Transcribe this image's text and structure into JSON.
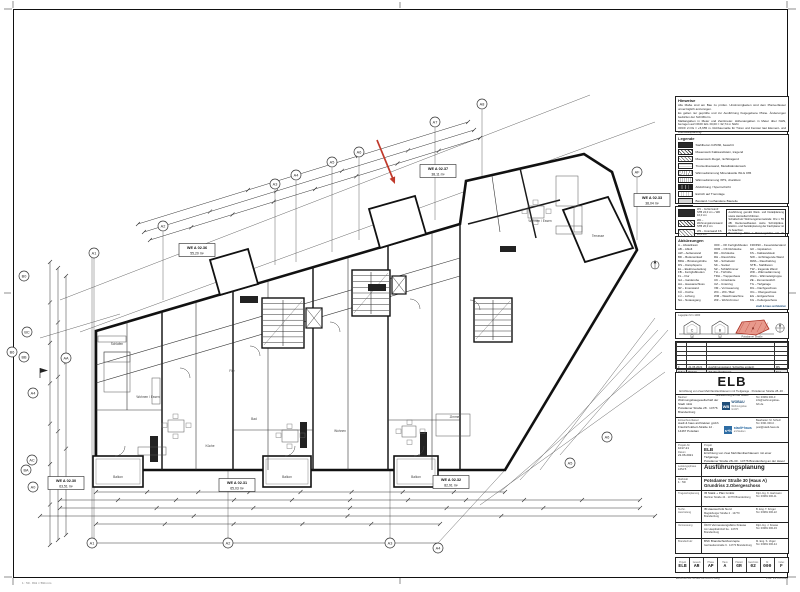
{
  "notes": {
    "title": "Hinweise",
    "lines": [
      "Alle Maße sind am Bau zu prüfen. Unstimmigkeiten sind dem Planverfasser unverzüglich anzuzeigen.",
      "Es gelten nur geprüfte und zur Ausführung freigegebene Pläne. Änderungen bedürfen der Schriftform.",
      "Maßangaben in Meter und Zentimeter. Höhenangaben in Meter über NHN, bezogen auf OKFF EG ±0,00 = 32,74 m NHN.",
      "OKFF 2.OG = +5,655 m. Rohbaumaße für Türen und Fenster laut Element- und Werkstattplanung.",
      "Brandschutz gemäß Brandschutzkonzept, Schallschutz nach DIN 4109, Wärmeschutz nach GEG.",
      "Türen: lichte Durchgangsmaße. Brüstungshöhen ab OKFF, BRH siehe Fensterliste.",
      "Abkürzungen und Legende siehe nebenstehende Übersicht."
    ]
  },
  "legend": {
    "title": "Legende",
    "items": [
      {
        "swatch": "solid",
        "label": "Stahlbeton C25/30, bewehrt"
      },
      {
        "swatch": "diag",
        "label": "Mauerwerk Kalksandstein, tragend"
      },
      {
        "swatch": "cross",
        "label": "Mauerwerk Ziegel, nichttragend"
      },
      {
        "swatch": "light",
        "label": "Trockenbauwand, Metallständerwerk"
      },
      {
        "swatch": "dots",
        "label": "Wärmedämmung Mineralwolle WLG 035"
      },
      {
        "swatch": "wave",
        "label": "Wärmedämmung XPS, druckfest"
      },
      {
        "swatch": "dark2",
        "label": "Abdichtung / Sperrschicht"
      },
      {
        "swatch": "grid",
        "label": "Estrich auf Trennlage"
      },
      {
        "swatch": "gray",
        "label": "Bestand / vorhandene Bauteile"
      },
      {
        "swatch": "hatch2",
        "label": "Installationsebene / Vorsatzschale"
      },
      {
        "swatch": "reddash",
        "label": "Umgrenzung Sicherheitstreppenraum"
      }
    ],
    "wall_types": [
      "W1 – Außenwand STB 24,0 cm + WD 16,0 cm",
      "W2 – Wohnungstrennwand STB 20,0 cm",
      "W3 – Innenwand KS 11,5 cm",
      "W4 – Trockenbauwand 10,0 cm"
    ],
    "note_box": [
      "Ausführung gemäß Werk- und Detailplanung sowie Herstellerrichtlinien.",
      "Schallschutz Wohnungstrennwände: R'w ≥ 55 dB. Deckenaufbauten siehe Schnittpläne. Elektro- und Sanitärplanung der Fachplaner ist zu beachten.",
      "Bemaßung: BRH = Brüstungshöhe roh ab OKRF. Alle Durchbrüche mit den Fachgewerken vor Ausführung abzustimmen."
    ]
  },
  "abbreviations": {
    "title": "Abkürzungen",
    "columns": [
      [
        "A – Abstellraum",
        "AB – Abluft",
        "AW – Außenwand",
        "BD – Bodeneinlauf",
        "BRH – Brüstungshöhe",
        "DS – Dampfsperre",
        "EL – Elektroverteilung",
        "FB – Fertigfußboden",
        "FL – Flur",
        "GA – Garderobe",
        "HA – Hausanschluss",
        "IW – Innenwand",
        "KÜ – Küche",
        "LÜ – Lüftung",
        "NA – Notausgang"
      ],
      [
        "OKF – OK Fertigfußboden",
        "OKR – OK Rohdecke",
        "RD – Rohdecke",
        "RH – Raumhöhe",
        "SD – Schiebetür",
        "SK – Sockel",
        "SZ – Schlafzimmer",
        "TH – Türhöhe",
        "TRH – Treppenhaus",
        "UK – Unterkante",
        "UZ – Unterzug",
        "VM – Vormauerung",
        "WC – WC / Bad",
        "WM – Waschmaschine",
        "WZ – Wohnzimmer"
      ],
      [
        "F30/F90 – Feuerwiderstand",
        "GK – Gipskarton",
        "KS – Kalksandstein",
        "NW – nichttragende Wand",
        "RWA – Rauchabzug",
        "STB – Stahlbeton",
        "TW – tragende Wand",
        "WD – Wärmedämmung",
        "WLG – Wärmeleitgruppe",
        "ZE – Zementestrich",
        "TG – Tiefgarage",
        "DG – Dachgeschoss",
        "OG – Obergeschoss",
        "EG – Erdgeschoss",
        "KG – Kellergeschoss"
      ]
    ],
    "logo_caption": "stadt & haus architekten"
  },
  "key_plan": {
    "title": "Lageplan M 1:1000",
    "houses": [
      "C",
      "B",
      "A"
    ],
    "street": "Potsdamer Straße",
    "badges": [
      "28",
      "30"
    ],
    "highlight_fill": "#e8998c",
    "highlight_stroke": "#a93226"
  },
  "revisions": {
    "headers": [
      "Index",
      "Datum",
      "Art der Änderung",
      "Gez."
    ],
    "filled": [
      "F",
      "21.06.2021",
      "Ausführungsstand, Schächte ergänzt",
      "MS"
    ],
    "empty_rows": 5
  },
  "title_block": {
    "code": "ELB",
    "subtitle": "Errichtung von zwei Mehrfamilienhäusern mit Tiefgarage · Potsdamer Straße 28–30 · Brandenburg an der Havel",
    "client": {
      "label": "Bauherr",
      "line1": "Wohnungsbaugesellschaft der Stadt mbH",
      "line2": "Potsdamer Straße 28 · 14776 Brandenburg",
      "contact1": "Tel. 03381 000-0",
      "contact2": "info@wohnungsbau-brb.de",
      "logo_text": "WB",
      "logo_name": "WOBAU",
      "logo_sub": "Wohnungsbau GmbH"
    },
    "architect": {
      "label": "Entwurfsverfasser",
      "line1": "stadt & haus architekten gmbh",
      "line2": "Friedrich-Ebert-Straße 12 · 14467 Potsdam",
      "contact1": "Bearbeiter: M. Schulz",
      "contact2": "Tel. 0331 000-0 · post@stadt-haus.de",
      "logo_text": "s+h",
      "logo_name": "stadt+haus",
      "logo_sub": "architekten"
    },
    "project": {
      "label": "Projekt",
      "number_label": "Projekt-Nr.",
      "number": "1017-21",
      "date_label": "Datum",
      "date": "21.06.2021",
      "name": "ELB",
      "desc1": "Errichtung von zwei Mehrfamilienhäusern mit einer Tiefgarage",
      "desc2": "Potsdamer Straße 28–30 · 14776 Brandenburg an der Havel · Haus A"
    },
    "phase": {
      "label": "Leistungsphase",
      "small": "LPH 5",
      "title": "Ausführungsplanung"
    },
    "content": {
      "label": "Maßstab",
      "scale": "1 : 50",
      "title": "Potsdamer Straße 30 (Haus A)  Grundriss 2.Obergeschoss"
    },
    "consultants": [
      {
        "role": "Tragwerksplanung",
        "firm": "IB Statik + Plan GmbH",
        "addr": "Berliner Straße 44 · 14770 Brandenburg",
        "c1": "Dipl.-Ing. K. Hartmann",
        "c2": "Tel. 03381 000-11"
      },
      {
        "role": "Techn. Ausrüstung",
        "firm": "IB Haustechnik Nord",
        "addr": "Magdeburger Straße 2 · 14770 Brandenburg",
        "c1": "B. Eng. T. Krüger",
        "c2": "Tel. 03381 000-22"
      },
      {
        "role": "Vermessung",
        "firm": "ÖbVI Vermessungsbüro Krause",
        "addr": "Am Hauptbahnhof 3a · 14776 Brandenburg",
        "c1": "Dipl.-Ing. J. Krause",
        "c2": "Tel. 03381 000-33"
      },
      {
        "role": "Brandschutz",
        "firm": "BSK Brandschutzkonzepte",
        "addr": "Gertraudenstraße 9 · 14770 Brandenburg",
        "c1": "M. Eng. S. Vogel",
        "c2": "Tel. 03381 000-44"
      }
    ]
  },
  "drawing_code": {
    "labels": [
      "Projekt",
      "Gewerk",
      "Phase",
      "Haus",
      "Planart",
      "Geschoss",
      "Nr.",
      "Index"
    ],
    "values": [
      "ELB",
      "AR",
      "AP",
      "A",
      "GR",
      "02",
      "000",
      "F"
    ]
  },
  "footer": {
    "left": "ELB-AR-AP-A-GR-02-000-F.dwg",
    "right": "Plot: 21.06.2021",
    "page_left": "1 : 50 · 841 × 594 mm"
  },
  "plan": {
    "watermark": "ELB",
    "arrow_color": "#c0392b",
    "axes": [
      {
        "label": "A2",
        "x": 163,
        "y": 226
      },
      {
        "label": "A3",
        "x": 275,
        "y": 184
      },
      {
        "label": "A4",
        "x": 296,
        "y": 175
      },
      {
        "label": "A5",
        "x": 332,
        "y": 162
      },
      {
        "label": "A6",
        "x": 359,
        "y": 152
      },
      {
        "label": "A7",
        "x": 435,
        "y": 122
      },
      {
        "label": "A8",
        "x": 482,
        "y": 104
      },
      {
        "label": "AF",
        "x": 637,
        "y": 172
      },
      {
        "label": "B0",
        "x": 24,
        "y": 276
      },
      {
        "label": "BC",
        "x": 27,
        "y": 332
      },
      {
        "label": "B6",
        "x": 12,
        "y": 352
      },
      {
        "label": "BB",
        "x": 24,
        "y": 357
      },
      {
        "label": "AA",
        "x": 66,
        "y": 358
      },
      {
        "label": "A4",
        "x": 33,
        "y": 393
      },
      {
        "label": "AC",
        "x": 32,
        "y": 460
      },
      {
        "label": "BA",
        "x": 26,
        "y": 470
      },
      {
        "label": "A0",
        "x": 33,
        "y": 487
      },
      {
        "label": "A1",
        "x": 94,
        "y": 253
      },
      {
        "label": "A1",
        "x": 92,
        "y": 543
      },
      {
        "label": "A2",
        "x": 228,
        "y": 543
      },
      {
        "label": "A3",
        "x": 390,
        "y": 543
      },
      {
        "label": "A4",
        "x": 438,
        "y": 548
      },
      {
        "label": "A5",
        "x": 570,
        "y": 463
      },
      {
        "label": "A6",
        "x": 607,
        "y": 437
      }
    ],
    "apartments": [
      {
        "id": "WE A 02.30",
        "area": "63,51 m²",
        "x": 66,
        "y": 483
      },
      {
        "id": "WE A 02.31",
        "area": "65,03 m²",
        "x": 237,
        "y": 485
      },
      {
        "id": "WE A 02.32",
        "area": "82,91 m²",
        "x": 451,
        "y": 482
      },
      {
        "id": "WE A 02.36",
        "area": "55,20 m²",
        "x": 197,
        "y": 250
      },
      {
        "id": "WE A 02.37",
        "area": "38,11 m²",
        "x": 438,
        "y": 171
      },
      {
        "id": "WE A 02.33",
        "area": "38,04 m²",
        "x": 652,
        "y": 200
      }
    ],
    "room_labels": [
      {
        "t": "Wohnen / Essen",
        "x": 148,
        "y": 398
      },
      {
        "t": "Schlafen",
        "x": 117,
        "y": 345
      },
      {
        "t": "Küche",
        "x": 210,
        "y": 447
      },
      {
        "t": "Bad",
        "x": 254,
        "y": 420
      },
      {
        "t": "Flur",
        "x": 232,
        "y": 372
      },
      {
        "t": "Wohnen",
        "x": 340,
        "y": 432
      },
      {
        "t": "Zimmer",
        "x": 455,
        "y": 418
      },
      {
        "t": "Wohnen / Essen",
        "x": 540,
        "y": 222
      },
      {
        "t": "Balkon",
        "x": 118,
        "y": 478
      },
      {
        "t": "Balkon",
        "x": 287,
        "y": 478
      },
      {
        "t": "Balkon",
        "x": 416,
        "y": 478
      },
      {
        "t": "Terrasse",
        "x": 598,
        "y": 237
      }
    ]
  }
}
